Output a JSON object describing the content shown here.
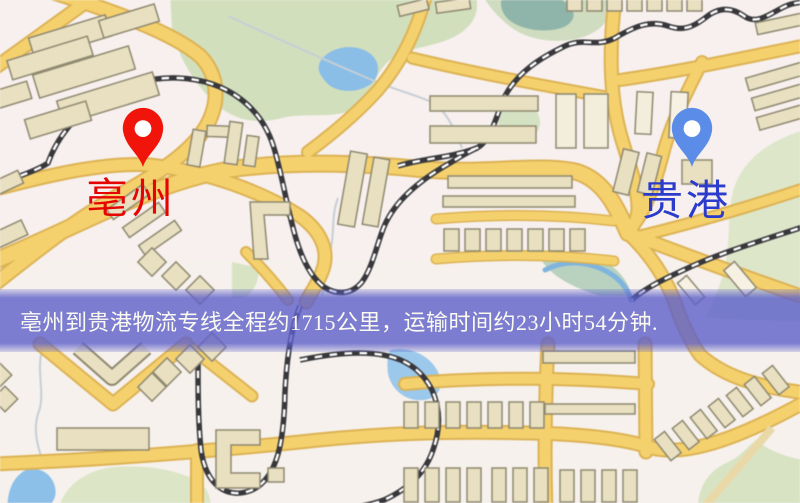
{
  "map": {
    "origin": {
      "name": "亳州",
      "label_color": "#e60400",
      "pin_color": "#f0140a"
    },
    "destination": {
      "name": "贵港",
      "label_color": "#2b3ccc",
      "pin_color": "#5b8ce8"
    },
    "banner": {
      "text": "亳州到贵港物流专线全程约1715公里，运输时间约23小时54分钟.",
      "bg_color": "#5d5fca",
      "text_color": "#fbfaf0"
    },
    "palette": {
      "land": "#f6f1ec",
      "road_fill": "#f5d16e",
      "road_edge": "#dcb254",
      "building": "#e9e0c1",
      "park": "#d2dfbd",
      "water": "#8cc0e9",
      "railway": "#38383c"
    }
  }
}
